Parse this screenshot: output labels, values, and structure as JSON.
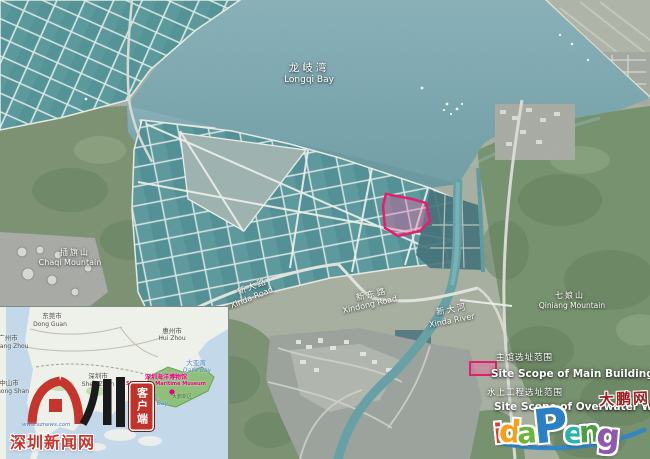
{
  "map": {
    "bay": {
      "zh": "龙岐湾",
      "en": "Longqi Bay"
    },
    "mountain_left": {
      "zh": "插旗山",
      "en": "Chaqi Mountain"
    },
    "mountain_right": {
      "zh": "七娘山",
      "en": "Qiniang Mountain"
    },
    "road_xinda": {
      "zh": "新大路",
      "en": "Xinda Road"
    },
    "road_xindong": {
      "zh": "新东路",
      "en": "Xindong Road"
    },
    "river_xinda": {
      "zh": "新大河",
      "en": "Xinda River"
    },
    "site_main": {
      "zh": "主馆选址范围",
      "en": "Site Scope of Main Building"
    },
    "site_water": {
      "zh": "水上工程选址范围",
      "en": "Site Scope of Overwater Works"
    }
  },
  "inset": {
    "cities": {
      "dongguan": {
        "zh": "东莞市",
        "en": "Dong Guan"
      },
      "huizhou": {
        "zh": "惠州市",
        "en": "Hui Zhou"
      },
      "guangzhou": {
        "zh": "广州市",
        "en": "Guang Zhou"
      },
      "zhongshan": {
        "zh": "中山市",
        "en": "Zhong Shan"
      },
      "shenzhen": {
        "zh": "深圳市",
        "en": "Shen Zhen"
      }
    },
    "bays": {
      "daya": {
        "zh": "大亚湾",
        "en": "DaYa Bay"
      },
      "dapeng": {
        "zh": "大鹏湾",
        "en": "DaPeng Bay"
      }
    },
    "museum": {
      "zh": "深圳海洋博物馆",
      "en": "Shenzhen Maritime Museum"
    },
    "district": {
      "zh": "大鹏新区"
    }
  },
  "logos": {
    "sznews": {
      "site_name": "深圳新闻网",
      "badge": "客户端",
      "url": "www.sznews.com"
    },
    "idapeng": {
      "cn": "大鹏网",
      "letters": [
        "i",
        "d",
        "a",
        "P",
        "e",
        "n",
        "g"
      ]
    }
  },
  "colors": {
    "highlight_pink": "#e4186c",
    "sea": "#7ba6ad",
    "pond": "#579199",
    "museum_pink": "#e6007e",
    "sznews_red": "#c5352b",
    "idapeng_letter_colors": [
      "#e23c30",
      "#f3a01d",
      "#6db33f",
      "#2a7fc5",
      "#2ab3a9",
      "#4a9f3f",
      "#8f57ad"
    ]
  }
}
